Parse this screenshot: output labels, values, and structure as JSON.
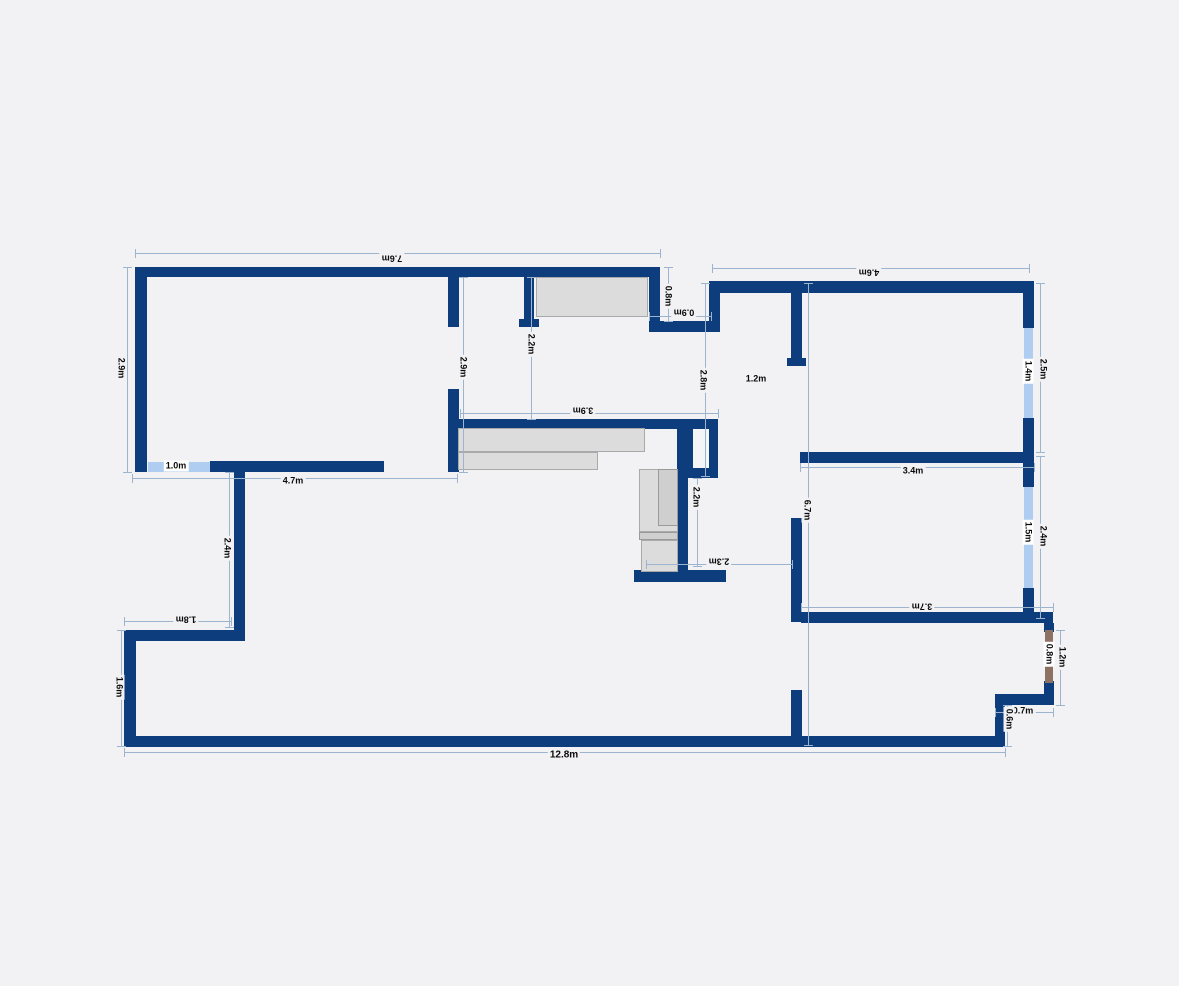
{
  "meta": {
    "drawing_type": "apartment-floor-plan",
    "units": "m"
  },
  "colors": {
    "background": "#f2f2f4",
    "wall": "#0e3d7d",
    "window": "#aecdf0",
    "door": "#8d7264",
    "dimension_line": "#9db4ce",
    "furniture_fill": "#dcdcdc",
    "furniture_border": "#a9a9a9",
    "label_text": "#0a0a0a"
  },
  "plan": {
    "walls": [
      {
        "name": "living-top-wall",
        "x": 135,
        "y": 267,
        "w": 525,
        "h": 10
      },
      {
        "name": "living-left-wall",
        "x": 135,
        "y": 267,
        "w": 12,
        "h": 205
      },
      {
        "name": "living-bottom-wall",
        "x": 210,
        "y": 461,
        "w": 174,
        "h": 11
      },
      {
        "name": "living-right-wall",
        "x": 649,
        "y": 267,
        "w": 11,
        "h": 65
      },
      {
        "name": "entry-top-step-wall",
        "x": 649,
        "y": 321,
        "w": 71,
        "h": 11
      },
      {
        "name": "entry-left-wall",
        "x": 709,
        "y": 281,
        "w": 11,
        "h": 51
      },
      {
        "name": "right-wing-top-wall",
        "x": 709,
        "y": 281,
        "w": 325,
        "h": 12
      },
      {
        "name": "right-exterior-wall-1",
        "x": 1023,
        "y": 281,
        "w": 11,
        "h": 47
      },
      {
        "name": "right-exterior-wall-2",
        "x": 1023,
        "y": 418,
        "w": 11,
        "h": 69
      },
      {
        "name": "right-exterior-wall-3",
        "x": 1023,
        "y": 588,
        "w": 11,
        "h": 35
      },
      {
        "name": "bedroom2-bottom-wall",
        "x": 801,
        "y": 612,
        "w": 252,
        "h": 11
      },
      {
        "name": "right-exterior-wall-4",
        "x": 1044,
        "y": 623,
        "w": 10,
        "h": 9
      },
      {
        "name": "right-exterior-wall-5",
        "x": 1044,
        "y": 681,
        "w": 10,
        "h": 24
      },
      {
        "name": "bottom-right-step-h",
        "x": 995,
        "y": 694,
        "w": 59,
        "h": 11
      },
      {
        "name": "bottom-right-step-v",
        "x": 995,
        "y": 694,
        "w": 10,
        "h": 52
      },
      {
        "name": "bottom-exterior-wall",
        "x": 124,
        "y": 736,
        "w": 881,
        "h": 11
      },
      {
        "name": "left-lower-exterior-wall",
        "x": 124,
        "y": 630,
        "w": 12,
        "h": 117
      },
      {
        "name": "left-step-wall",
        "x": 124,
        "y": 630,
        "w": 121,
        "h": 11
      },
      {
        "name": "mid-left-partition",
        "x": 234,
        "y": 461,
        "w": 11,
        "h": 180
      },
      {
        "name": "hall-stub-a",
        "x": 448,
        "y": 277,
        "w": 11,
        "h": 50
      },
      {
        "name": "hall-stub-b",
        "x": 524,
        "y": 277,
        "w": 10,
        "h": 50
      },
      {
        "name": "hall-stub-b-foot",
        "x": 519,
        "y": 319,
        "w": 20,
        "h": 8
      },
      {
        "name": "kitchen-left-wall",
        "x": 448,
        "y": 389,
        "w": 11,
        "h": 83
      },
      {
        "name": "kitchen-top-wall",
        "x": 452,
        "y": 419,
        "w": 232,
        "h": 10
      },
      {
        "name": "kitchen-right-wall",
        "x": 677,
        "y": 419,
        "w": 11,
        "h": 156
      },
      {
        "name": "kitchen-bottom-wall",
        "x": 634,
        "y": 570,
        "w": 92,
        "h": 12
      },
      {
        "name": "hall-right-wall-upper",
        "x": 791,
        "y": 288,
        "w": 11,
        "h": 78
      },
      {
        "name": "hall-right-wall-upper-foot",
        "x": 787,
        "y": 358,
        "w": 19,
        "h": 8
      },
      {
        "name": "hall-right-wall-lower",
        "x": 791,
        "y": 518,
        "w": 11,
        "h": 104
      },
      {
        "name": "bedroom1-bottom-wall",
        "x": 800,
        "y": 452,
        "w": 234,
        "h": 11
      },
      {
        "name": "hall-bottom-stub",
        "x": 791,
        "y": 690,
        "w": 11,
        "h": 46
      }
    ],
    "duct": {
      "outer": {
        "x": 684,
        "y": 419,
        "w": 34,
        "h": 59
      },
      "inner": {
        "x": 693,
        "y": 429,
        "w": 16,
        "h": 39
      }
    },
    "windows": [
      {
        "name": "window-living-south",
        "x": 148,
        "y": 462,
        "w": 62,
        "h": 10
      },
      {
        "name": "window-bedroom1-east",
        "x": 1024,
        "y": 328,
        "w": 9,
        "h": 90
      },
      {
        "name": "window-bedroom2-east",
        "x": 1024,
        "y": 487,
        "w": 9,
        "h": 101
      }
    ],
    "doors": [
      {
        "name": "door-east-entry",
        "x": 1045,
        "y": 630,
        "w": 8,
        "h": 53
      }
    ],
    "furniture": [
      {
        "name": "entry-wardrobe",
        "x": 536,
        "y": 277,
        "w": 112,
        "h": 40,
        "shade": "light"
      },
      {
        "name": "kitchen-counter-upper",
        "x": 458,
        "y": 428,
        "w": 187,
        "h": 24,
        "shade": "light"
      },
      {
        "name": "kitchen-counter-lower",
        "x": 458,
        "y": 452,
        "w": 140,
        "h": 18,
        "shade": "light"
      },
      {
        "name": "kitchen-appliance-tall",
        "x": 639,
        "y": 469,
        "w": 39,
        "h": 63,
        "shade": "light"
      },
      {
        "name": "kitchen-appliance-tall-inner",
        "x": 658,
        "y": 469,
        "w": 20,
        "h": 57,
        "shade": "dark"
      },
      {
        "name": "kitchen-appliance-strip",
        "x": 639,
        "y": 532,
        "w": 39,
        "h": 8,
        "shade": "dark"
      },
      {
        "name": "kitchen-appliance-lower",
        "x": 641,
        "y": 540,
        "w": 37,
        "h": 32,
        "shade": "light"
      }
    ],
    "dimensions": [
      {
        "label": "7.6m",
        "lx": 392,
        "ly": 258,
        "rot": "r180",
        "line": {
          "x1": 135,
          "y1": 253,
          "x2": 660,
          "y2": 253
        }
      },
      {
        "label": "2.9m",
        "lx": 121,
        "ly": 368,
        "rot": "r90",
        "line": {
          "x1": 127,
          "y1": 267,
          "x2": 127,
          "y2": 472
        }
      },
      {
        "label": "4.6m",
        "lx": 869,
        "ly": 272,
        "rot": "r180",
        "line": {
          "x1": 712,
          "y1": 268,
          "x2": 1029,
          "y2": 268
        }
      },
      {
        "label": "0.8m",
        "lx": 668,
        "ly": 296,
        "rot": "r90",
        "line": {
          "x1": 668,
          "y1": 267,
          "x2": 668,
          "y2": 321
        }
      },
      {
        "label": "0.9m",
        "lx": 684,
        "ly": 312,
        "rot": "r180",
        "line": {
          "x1": 649,
          "y1": 316,
          "x2": 711,
          "y2": 316
        }
      },
      {
        "label": "2.9m",
        "lx": 463,
        "ly": 367,
        "rot": "r90",
        "line": {
          "x1": 463,
          "y1": 277,
          "x2": 463,
          "y2": 472
        }
      },
      {
        "label": "2.2m",
        "lx": 531,
        "ly": 344,
        "rot": "r90",
        "line": {
          "x1": 531,
          "y1": 277,
          "x2": 531,
          "y2": 419
        }
      },
      {
        "label": "2.8m",
        "lx": 703,
        "ly": 380,
        "rot": "r90",
        "line": {
          "x1": 705,
          "y1": 283,
          "x2": 705,
          "y2": 476
        }
      },
      {
        "label": "1.2m",
        "lx": 756,
        "ly": 379,
        "rot": "r0",
        "line": null
      },
      {
        "label": "1.4m",
        "lx": 1028,
        "ly": 371,
        "rot": "r90",
        "whitebg": true,
        "line": null
      },
      {
        "label": "2.5m",
        "lx": 1043,
        "ly": 369,
        "rot": "r90",
        "line": {
          "x1": 1040,
          "y1": 283,
          "x2": 1040,
          "y2": 452
        }
      },
      {
        "label": "3.4m",
        "lx": 913,
        "ly": 471,
        "rot": "r0",
        "line": {
          "x1": 800,
          "y1": 467,
          "x2": 1034,
          "y2": 467
        }
      },
      {
        "label": "6.7m",
        "lx": 807,
        "ly": 510,
        "rot": "r90",
        "line": {
          "x1": 808,
          "y1": 283,
          "x2": 808,
          "y2": 745
        }
      },
      {
        "label": "1.5m",
        "lx": 1028,
        "ly": 532,
        "rot": "r90",
        "whitebg": true,
        "line": null
      },
      {
        "label": "2.4m",
        "lx": 1043,
        "ly": 536,
        "rot": "r90",
        "line": {
          "x1": 1040,
          "y1": 456,
          "x2": 1040,
          "y2": 618
        }
      },
      {
        "label": "3.7m",
        "lx": 922,
        "ly": 606,
        "rot": "r180",
        "line": {
          "x1": 801,
          "y1": 607,
          "x2": 1053,
          "y2": 607
        }
      },
      {
        "label": "2.2m",
        "lx": 696,
        "ly": 497,
        "rot": "r90",
        "line": {
          "x1": 697,
          "y1": 478,
          "x2": 697,
          "y2": 566
        }
      },
      {
        "label": "2.3m",
        "lx": 719,
        "ly": 561,
        "rot": "r180",
        "line": {
          "x1": 646,
          "y1": 564,
          "x2": 792,
          "y2": 564
        }
      },
      {
        "label": "3.9m",
        "lx": 583,
        "ly": 410,
        "rot": "r180",
        "line": {
          "x1": 460,
          "y1": 413,
          "x2": 718,
          "y2": 413
        }
      },
      {
        "label": "1.0m",
        "lx": 176,
        "ly": 466,
        "rot": "r0",
        "whitebg": true,
        "line": null
      },
      {
        "label": "4.7m",
        "lx": 293,
        "ly": 481,
        "rot": "r0",
        "line": {
          "x1": 132,
          "y1": 478,
          "x2": 457,
          "y2": 478
        }
      },
      {
        "label": "2.4m",
        "lx": 227,
        "ly": 548,
        "rot": "r90",
        "line": {
          "x1": 229,
          "y1": 472,
          "x2": 229,
          "y2": 627
        }
      },
      {
        "label": "1.8m",
        "lx": 186,
        "ly": 619,
        "rot": "r180",
        "line": {
          "x1": 124,
          "y1": 621,
          "x2": 231,
          "y2": 621
        }
      },
      {
        "label": "1.6m",
        "lx": 119,
        "ly": 687,
        "rot": "r90",
        "line": {
          "x1": 121,
          "y1": 630,
          "x2": 121,
          "y2": 746
        }
      },
      {
        "label": "12.8m",
        "lx": 564,
        "ly": 755,
        "rot": "r0",
        "big": true,
        "line": {
          "x1": 124,
          "y1": 752,
          "x2": 1005,
          "y2": 752
        }
      },
      {
        "label": "0.8m",
        "lx": 1049,
        "ly": 654,
        "rot": "r90",
        "whitebg": true,
        "line": null
      },
      {
        "label": "1.2m",
        "lx": 1062,
        "ly": 657,
        "rot": "r90",
        "line": {
          "x1": 1060,
          "y1": 630,
          "x2": 1060,
          "y2": 705
        }
      },
      {
        "label": "0.7m",
        "lx": 1023,
        "ly": 711,
        "rot": "r0",
        "line": {
          "x1": 995,
          "y1": 712,
          "x2": 1053,
          "y2": 712
        }
      },
      {
        "label": "0.6m",
        "lx": 1009,
        "ly": 719,
        "rot": "r90",
        "line": {
          "x1": 1007,
          "y1": 705,
          "x2": 1007,
          "y2": 746
        }
      }
    ]
  }
}
